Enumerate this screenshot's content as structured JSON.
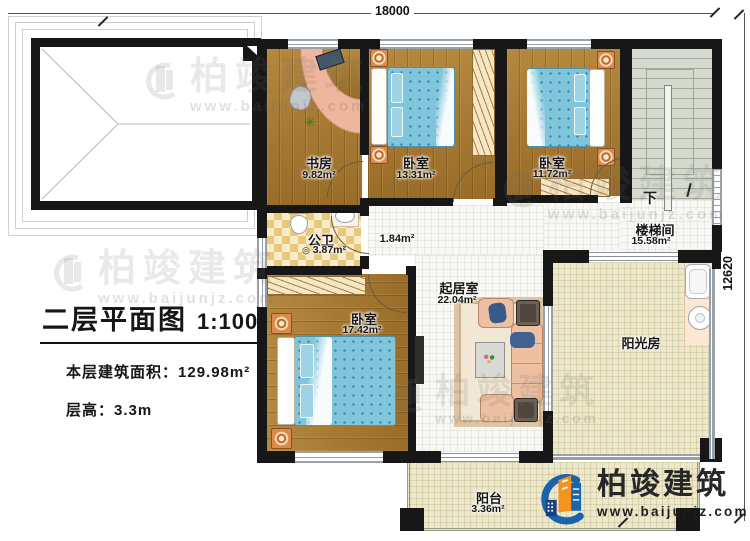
{
  "dimensions": {
    "top_width": "18000",
    "right_height": "12620"
  },
  "title_block": {
    "title": "二层平面图",
    "scale": "1:100",
    "area_label": "本层建筑面积：",
    "area_value": "129.98m²",
    "floor_height_label": "层高：",
    "floor_height_value": "3.3m"
  },
  "rooms": {
    "study": {
      "name": "书房",
      "area": "9.82m²"
    },
    "bedroom_top": {
      "name": "卧室",
      "area": "13.31m²"
    },
    "bedroom_right": {
      "name": "卧室",
      "area": "11.72m²"
    },
    "stairwell": {
      "name": "楼梯间",
      "area": "15.58m²",
      "direction": "下"
    },
    "bathroom": {
      "name": "公卫",
      "area": "3.87m²"
    },
    "hallway": {
      "area": "1.84m²"
    },
    "bedroom_big": {
      "name": "卧室",
      "area": "17.42m²"
    },
    "living": {
      "name": "起居室",
      "area": "22.04m²"
    },
    "sunroom": {
      "name": "阳光房"
    },
    "balcony": {
      "name": "阳台",
      "area": "3.36m²"
    }
  },
  "branding": {
    "company": "柏竣建筑",
    "website": "www.baijunjz.com"
  },
  "watermark": {
    "company": "柏竣建筑",
    "website": "www.baijunjz.com"
  },
  "icons": {
    "plant": "✳",
    "drain": "◎"
  },
  "colors": {
    "wall": "#171717",
    "wood_floor": "#a8792f",
    "bathroom_tile": "#e9c77c",
    "bed_blue": "#7fc6dc",
    "sofa_salmon": "#edc0a2",
    "logo_blue": "#1b63ad",
    "logo_orange": "#f6921e"
  }
}
